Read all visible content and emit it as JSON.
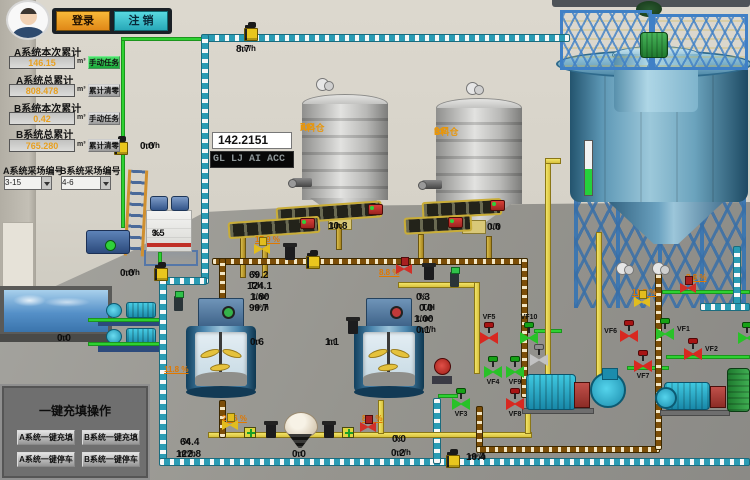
{
  "header": {
    "login": "登录",
    "logout": "注 销"
  },
  "totalizer": {
    "rows": [
      {
        "label": "A系统本次累计",
        "value": "146.15",
        "unit": "m³",
        "action": "手动任务",
        "style": "green"
      },
      {
        "label": "A系统总累计",
        "value": "808.478",
        "unit": "m³",
        "action": "累计清零",
        "style": "gray"
      },
      {
        "label": "B系统本次累计",
        "value": "0.42",
        "unit": "m³",
        "action": "手动任务",
        "style": "gray"
      },
      {
        "label": "B系统总累计",
        "value": "765.280",
        "unit": "m³",
        "action": "累计清零",
        "style": "gray"
      }
    ]
  },
  "sampling": {
    "a_label": "A系统采场编号",
    "a_value": "3-15",
    "b_label": "B系统采场编号",
    "b_value": "4-6"
  },
  "quick_ops": {
    "title": "一键充填操作",
    "buttons": [
      "A系统一键充填",
      "B系统一键充填",
      "A系统一键停车",
      "B系统一键停车"
    ]
  },
  "displays": {
    "number": "142.2151",
    "marquee": "GL LJ AI ACC"
  },
  "silos": {
    "a": {
      "name": "A料仓",
      "level": "7.2",
      "unit": "m"
    },
    "b": {
      "name": "B料仓",
      "level": "9.7",
      "unit": "m"
    }
  },
  "station": {
    "level": "3.5",
    "unit": "%"
  },
  "colors": {
    "accent_orange": "#e8960a",
    "pipe_green": "#2ed132",
    "pipe_cyan": "#2a9cb4",
    "pipe_yellow": "#e8d44a",
    "valve_red": "#d82820",
    "valve_green": "#28c228"
  },
  "readings": [
    {
      "value": "0.0",
      "unit": "m³/h",
      "x": 140,
      "y": 141
    },
    {
      "value": "8.7",
      "unit": "m³/h",
      "x": 236,
      "y": 44
    },
    {
      "value": "0.0",
      "unit": "m³/h",
      "x": 120,
      "y": 268
    },
    {
      "value": "10.8",
      "unit": "t/h",
      "x": 328,
      "y": 221
    },
    {
      "value": "0.0",
      "unit": "t/h",
      "x": 487,
      "y": 222
    },
    {
      "value": "69.2",
      "unit": "%",
      "x": 249,
      "y": 270
    },
    {
      "value": "124.1",
      "unit": "T/H",
      "x": 247,
      "y": 281
    },
    {
      "value": "1.80",
      "unit": "t/m³",
      "x": 250,
      "y": 292
    },
    {
      "value": "99.7",
      "unit": "m³/h",
      "x": 249,
      "y": 303
    },
    {
      "value": "0.3",
      "unit": "%",
      "x": 416,
      "y": 292
    },
    {
      "value": "0.0",
      "unit": "T/H",
      "x": 419,
      "y": 303
    },
    {
      "value": "1.00",
      "unit": "t/m³",
      "x": 414,
      "y": 314
    },
    {
      "value": "0.1",
      "unit": "m³/h",
      "x": 416,
      "y": 325
    },
    {
      "value": "0.6",
      "unit": "m",
      "x": 250,
      "y": 337
    },
    {
      "value": "1.1",
      "unit": "m",
      "x": 325,
      "y": 337
    },
    {
      "value": "64.4",
      "unit": "%",
      "x": 180,
      "y": 437
    },
    {
      "value": "122.8",
      "unit": "m³/h",
      "x": 176,
      "y": 449
    },
    {
      "value": "0.0",
      "unit": "m",
      "x": 292,
      "y": 449
    },
    {
      "value": "0.0",
      "unit": "%",
      "x": 392,
      "y": 434
    },
    {
      "value": "0.2",
      "unit": "m³/h",
      "x": 391,
      "y": 448
    },
    {
      "value": "19.4",
      "unit": "m³/h",
      "x": 466,
      "y": 452
    },
    {
      "value": "0.0",
      "unit": "m",
      "x": 57,
      "y": 333
    }
  ],
  "percent_labels": [
    {
      "text": "17.9 %",
      "x": 255,
      "y": 235
    },
    {
      "text": "8.8 %",
      "x": 379,
      "y": 268
    },
    {
      "text": "11.8 %",
      "x": 164,
      "y": 365
    },
    {
      "text": "26.6 %",
      "x": 222,
      "y": 414
    },
    {
      "text": "8.8 %",
      "x": 362,
      "y": 414
    },
    {
      "text": "11.5 %",
      "x": 632,
      "y": 288
    },
    {
      "text": "8.8 %",
      "x": 686,
      "y": 273
    }
  ],
  "valves": [
    {
      "label": "VF5",
      "x": 480,
      "y": 322,
      "color": "red",
      "pos": "above"
    },
    {
      "label": "VF10",
      "x": 520,
      "y": 322,
      "color": "green",
      "pos": "above"
    },
    {
      "label": "VF4",
      "x": 484,
      "y": 356,
      "color": "green",
      "pos": "below"
    },
    {
      "label": "VF9",
      "x": 506,
      "y": 356,
      "color": "green",
      "pos": "below"
    },
    {
      "label": "",
      "x": 530,
      "y": 344,
      "color": "gray",
      "pos": "none"
    },
    {
      "label": "VF3",
      "x": 452,
      "y": 388,
      "color": "green",
      "pos": "below"
    },
    {
      "label": "VF8",
      "x": 506,
      "y": 388,
      "color": "red",
      "pos": "below"
    },
    {
      "label": "VF6",
      "x": 620,
      "y": 320,
      "color": "red",
      "pos": "left"
    },
    {
      "label": "VF1",
      "x": 656,
      "y": 318,
      "color": "green",
      "pos": "right"
    },
    {
      "label": "VF2",
      "x": 684,
      "y": 338,
      "color": "red",
      "pos": "right"
    },
    {
      "label": "VF7",
      "x": 634,
      "y": 350,
      "color": "red",
      "pos": "below"
    },
    {
      "label": "",
      "x": 738,
      "y": 322,
      "color": "green",
      "pos": "none"
    }
  ],
  "equipment": [
    {
      "t": "flow",
      "x": 114,
      "y": 136
    },
    {
      "t": "flow",
      "x": 244,
      "y": 22
    },
    {
      "t": "flow",
      "x": 154,
      "y": 262
    },
    {
      "t": "flow",
      "x": 446,
      "y": 449
    },
    {
      "t": "flow",
      "x": 306,
      "y": 250
    },
    {
      "t": "meter",
      "x": 285,
      "y": 246
    },
    {
      "t": "meter",
      "x": 424,
      "y": 266
    },
    {
      "t": "meter",
      "x": 348,
      "y": 320
    },
    {
      "t": "meter",
      "x": 266,
      "y": 424
    },
    {
      "t": "meter",
      "x": 324,
      "y": 424
    },
    {
      "t": "green",
      "x": 174,
      "y": 296
    },
    {
      "t": "green",
      "x": 450,
      "y": 272
    },
    {
      "t": "yvalve",
      "x": 254,
      "y": 244
    },
    {
      "t": "yvalve",
      "x": 222,
      "y": 420
    },
    {
      "t": "yvalve",
      "x": 634,
      "y": 297
    },
    {
      "t": "gplus",
      "x": 244,
      "y": 427
    },
    {
      "t": "gplus",
      "x": 342,
      "y": 427
    },
    {
      "t": "rvalve",
      "x": 396,
      "y": 264
    },
    {
      "t": "rvalve",
      "x": 680,
      "y": 283
    },
    {
      "t": "rvalve",
      "x": 360,
      "y": 422
    },
    {
      "t": "blower",
      "x": 316,
      "y": 78
    },
    {
      "t": "blower",
      "x": 466,
      "y": 82
    },
    {
      "t": "blower",
      "x": 616,
      "y": 262
    },
    {
      "t": "blower",
      "x": 652,
      "y": 262
    },
    {
      "t": "motor",
      "x": 368,
      "y": 204
    },
    {
      "t": "motor",
      "x": 300,
      "y": 218
    },
    {
      "t": "motor",
      "x": 490,
      "y": 200
    },
    {
      "t": "motor",
      "x": 448,
      "y": 217
    },
    {
      "t": "rpump",
      "x": 432,
      "y": 356
    },
    {
      "t": "nozzle",
      "x": 292,
      "y": 178
    },
    {
      "t": "nozzle",
      "x": 422,
      "y": 180
    }
  ]
}
